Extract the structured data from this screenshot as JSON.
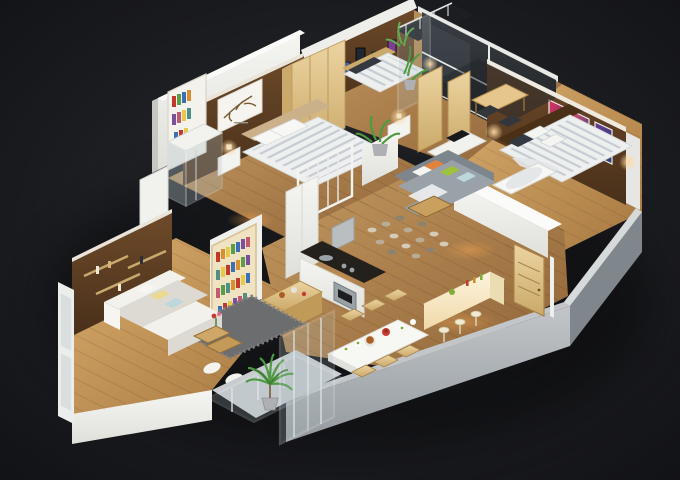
{
  "meta": {
    "type": "isometric-3d-floor-plan",
    "subject": "3D cutaway floor plan render of a three-bedroom apartment on a dark background"
  },
  "rooms": {
    "bedroom1": "Bedroom 1",
    "bedroom2": "Bedroom 2",
    "office": "Home office",
    "master": "Master bedroom",
    "bath": "Bathroom with tub",
    "shower": "Shower room",
    "living": "Living room",
    "family": "Family lounge",
    "kitchen": "Kitchen",
    "dining": "Dining room",
    "entry": "Entry with breakfast bar",
    "balconyTop": "Upper balcony",
    "balconyBottom": "Lower balcony"
  },
  "colors": {
    "bg-center": "#2a2c31",
    "bg-edge": "#101114",
    "wall-white": "#f5f5f2",
    "wall-top": "#fbfbf9",
    "wall-shade": "#d2d2cf",
    "wall-cap": "#c6c6c3",
    "gray-wall-light": "#c2c6c9",
    "gray-wall": "#949a9f",
    "gray-wall-dark": "#7f868c",
    "wood-floor-1": "#c49a62",
    "wood-floor-2": "#8f6336",
    "wood-warm-1": "#d8ab6c",
    "wood-warm-2": "#a4763f",
    "wood-dark-1": "#6e4a2a",
    "wood-dark-2": "#49301a",
    "light-wood-1": "#ecd4a0",
    "light-wood-2": "#cba96a",
    "light-wood-edge": "#b28e4e",
    "glass-dark-1": "#3b4046",
    "glass-dark-2": "#15171a",
    "glass-tint": "#aebfc4",
    "mullion": "#e9edee",
    "sofa-gray": "#99a1a9",
    "sofa-gray-dark": "#7d858d",
    "sofa-white": "#f2f1ec",
    "sofa-white-shade": "#dcdad2",
    "rug-gray": "#6b6d6f",
    "rug-dot-1": "#d6cbb6",
    "rug-dot-2": "#b9ac94",
    "rug-dot-3": "#8d8170",
    "counter-dark": "#24211d",
    "steel": "#9aa2a7",
    "hood-gray": "#b9bec1",
    "bed-white": "#eef0ef",
    "stripe-gray": "#c6ccd4",
    "headboard-tan": "#cbb189",
    "headboard-dark": "#4a3016",
    "pillow-dark": "#343941",
    "pillow-orange": "#e2833b",
    "pillow-green": "#9fc23c",
    "pillow-yellow": "#ead98f",
    "pillow-blue": "#bcd8dd",
    "plant-green": "#4e9a40",
    "plant-dark": "#3c7e34",
    "plant-light": "#5fae4c",
    "pot-gray": "#aeb0b3",
    "glow-warm": "#ffd9a0",
    "pool-warm": "#ffaa50",
    "bar-light-1": "#fdf3dc",
    "bar-light-2": "#f0d9a8",
    "tub-white": "#f7f7f5",
    "food-red": "#c63d2f",
    "food-green": "#7fae3a",
    "food-brown": "#a95f22",
    "dish-white": "#e8e4da",
    "branch-brown": "#7a5a33"
  },
  "palettes": {
    "books": [
      "#c0392b",
      "#d98e32",
      "#e8c84a",
      "#5a9e4b",
      "#3d6fb4",
      "#7a4f9e",
      "#c4586e",
      "#4f8f86"
    ],
    "posters": [
      "#c03a50",
      "#23262c",
      "#3c5f9e",
      "#1f2731",
      "#2e8f83",
      "#7a3f8f"
    ],
    "art": [
      "#d8365a",
      "#7a2e86",
      "#e04a6a",
      "#32427e",
      "#6a3c8f",
      "#2b3f77"
    ]
  }
}
